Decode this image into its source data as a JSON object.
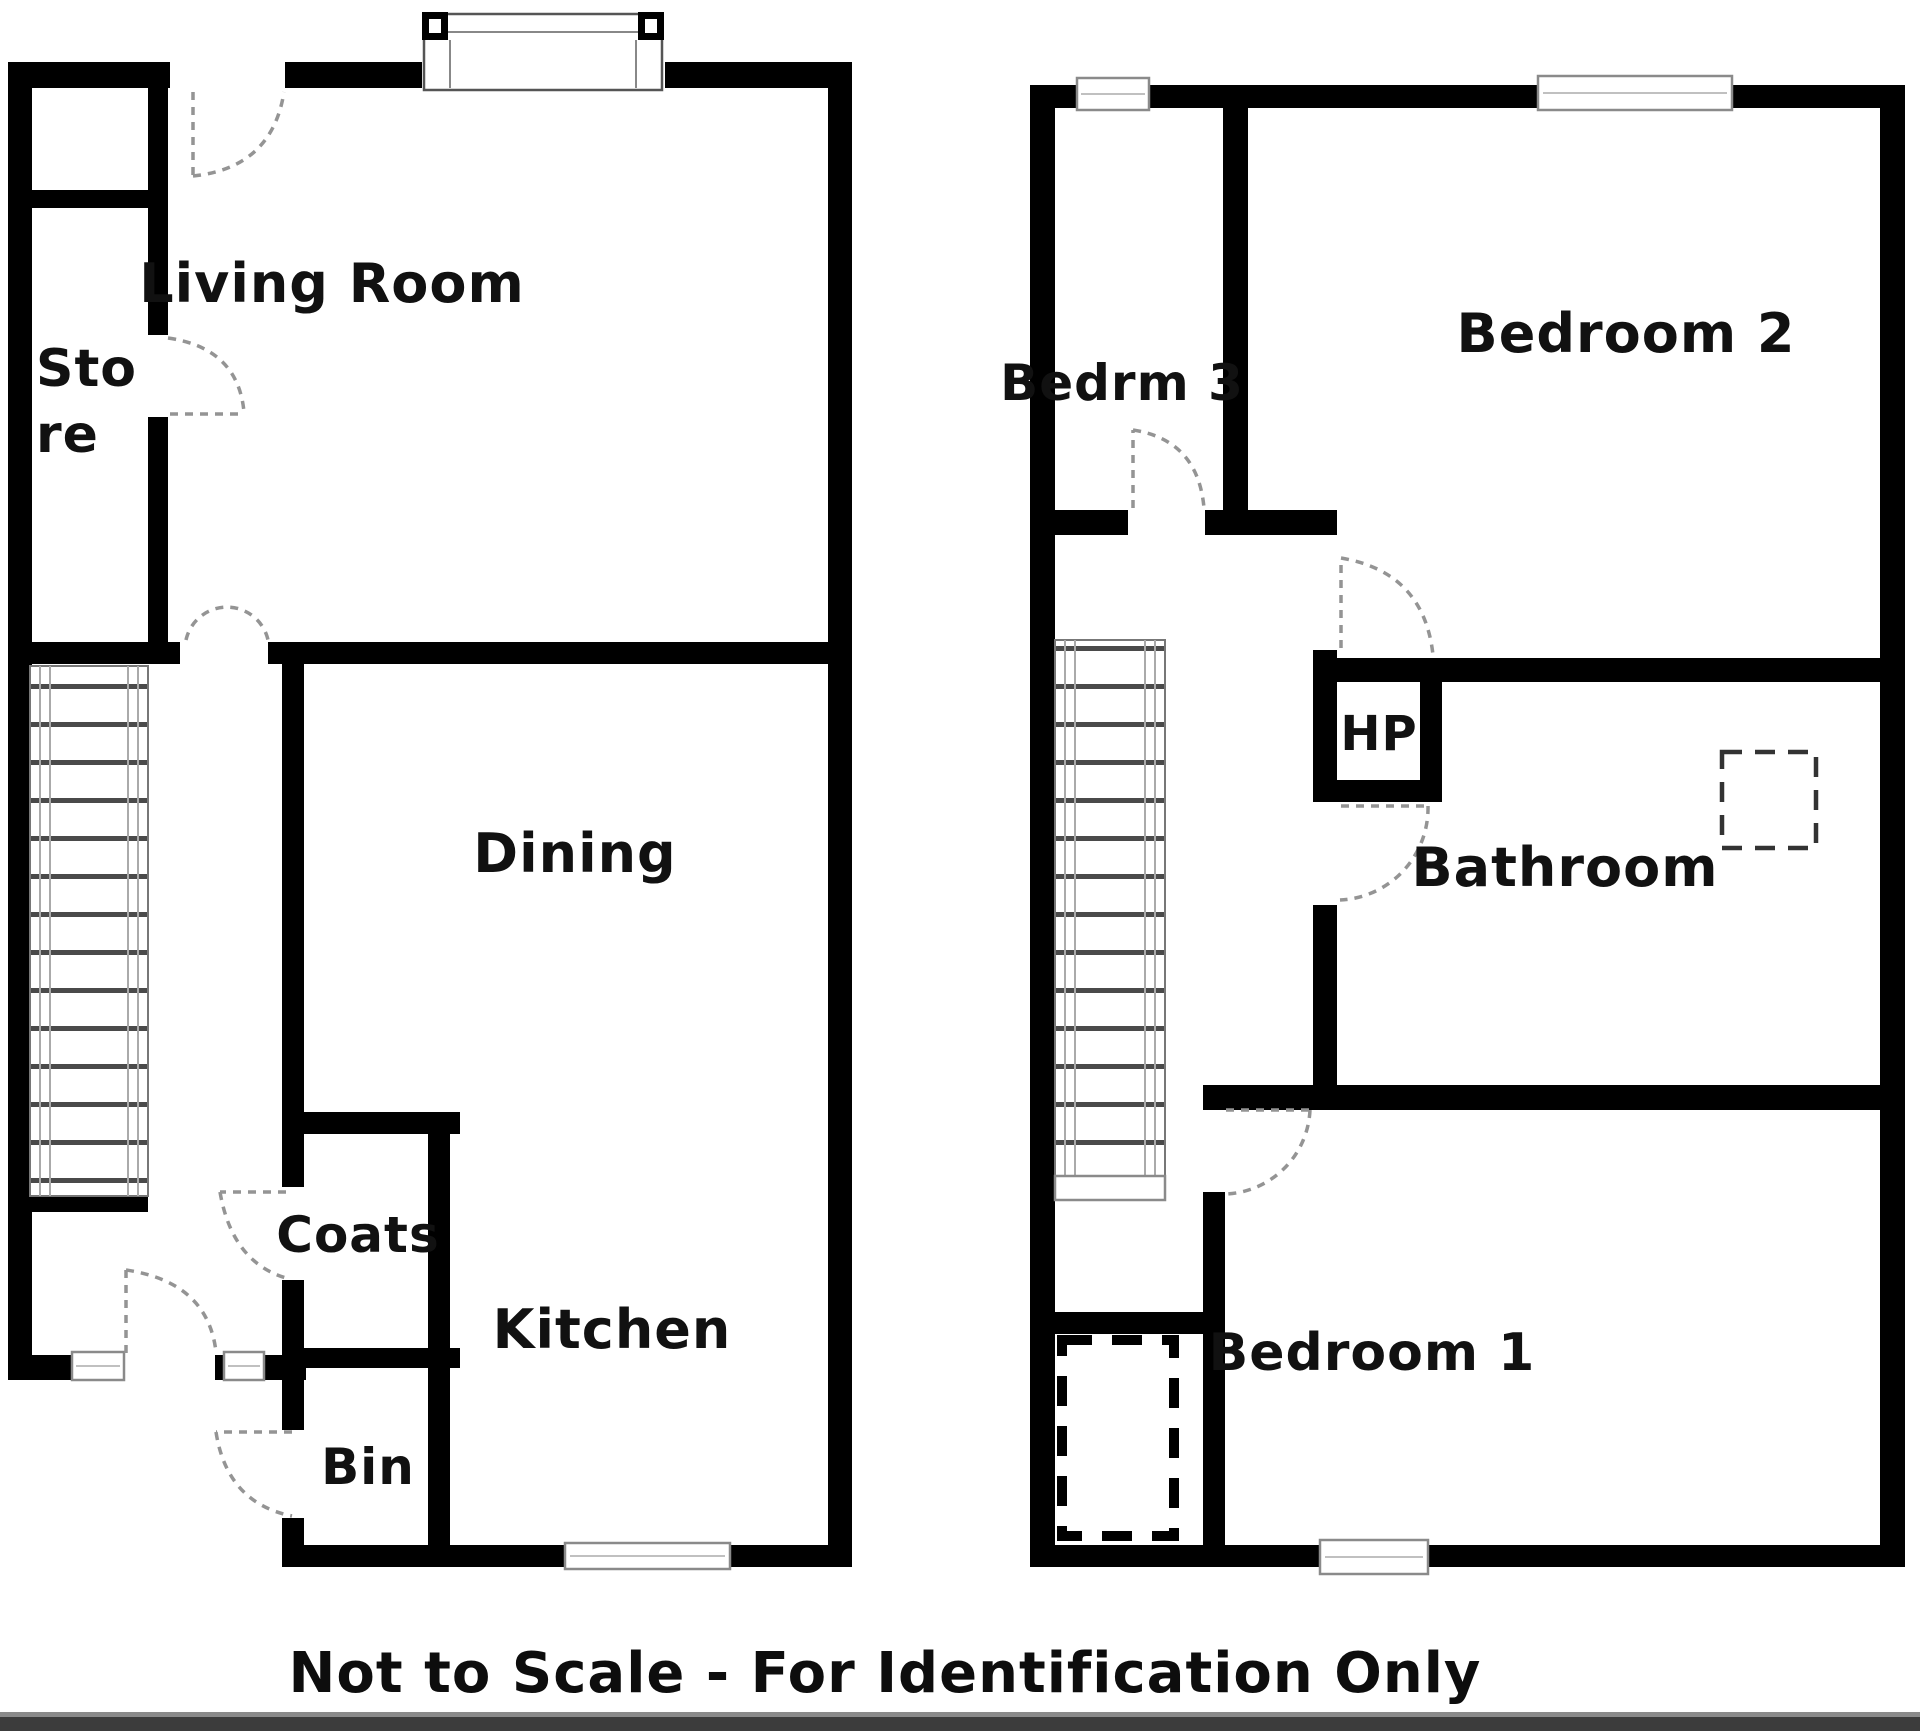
{
  "floorplan": {
    "ground_floor": {
      "living_room": "Living Room",
      "store_line_1": "Sto",
      "store_line_2": "re",
      "dining": "Dining",
      "coats": "Coats",
      "kitchen": "Kitchen",
      "bin": "Bin"
    },
    "first_floor": {
      "bedroom_3": "Bedrm 3",
      "bedroom_2": "Bedroom 2",
      "hp": "HP",
      "bathroom": "Bathroom",
      "bedroom_1": "Bedroom 1"
    },
    "footer": "Not to Scale - For Identification Only",
    "colors": {
      "wall": "#000000",
      "background": "#ffffff",
      "door_arc": "#949494",
      "window_frame": "#8a8a8a",
      "bottom_bar": "#3c3c3c"
    }
  }
}
